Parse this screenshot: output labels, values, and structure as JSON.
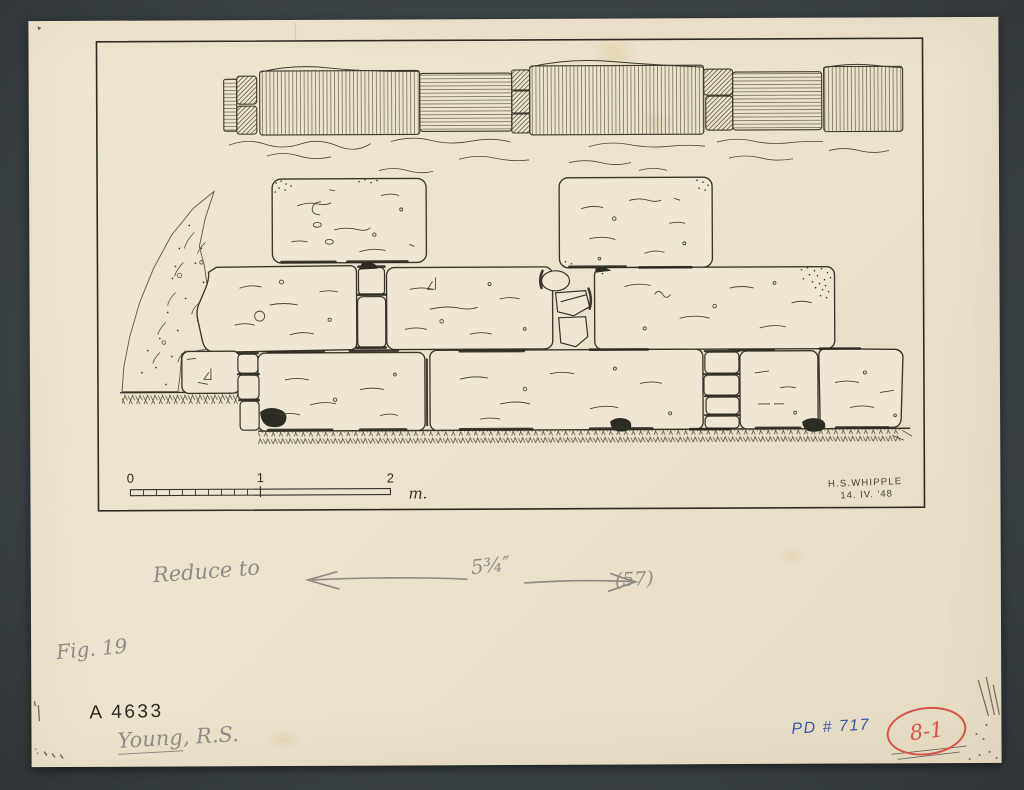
{
  "figure": {
    "scale_bar": {
      "tick_0": "0",
      "tick_1": "1",
      "tick_2": "2",
      "unit": "m."
    },
    "signature": {
      "name": "H.S.WHIPPLE",
      "date": "14. IV. '48"
    }
  },
  "annotations": {
    "reduce_note": "Reduce to",
    "reduce_measure": "5¾″",
    "reduce_target": "(57)",
    "figure_label": "Fig. 19",
    "accession_number": "A 4633",
    "author_surname": "Young",
    "author_initials": ", R.S.",
    "pd_number": "PD # 717",
    "plate_code": "8-1"
  },
  "colors": {
    "board": "#3d4446",
    "paper": "#ece3ce",
    "ink": "#3a372c",
    "pencil": "#8f8c84",
    "blue_ink": "#4058a8",
    "red_stamp": "#d9534a"
  }
}
